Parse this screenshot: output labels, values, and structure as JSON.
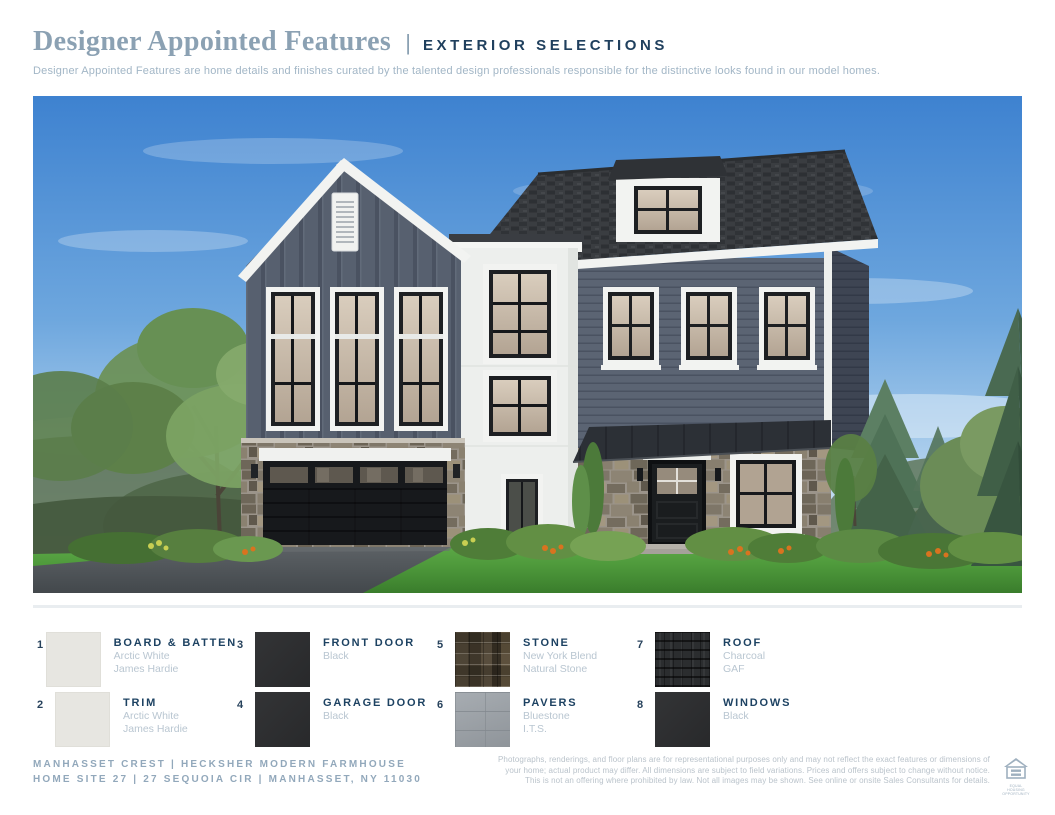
{
  "header": {
    "title": "Designer Appointed Features",
    "divider": "|",
    "subtitle_tag": "EXTERIOR SELECTIONS",
    "description": "Designer Appointed Features are home details and finishes curated by the talented design professionals responsible for the distinctive looks found in our model homes.",
    "title_color": "#8ba1b3",
    "tag_color": "#20405e"
  },
  "legend": {
    "items": [
      {
        "num": "1",
        "name": "BOARD & BATTEN",
        "line1": "Arctic White",
        "line2": "James Hardie",
        "swatch": "arctic-white",
        "swatch_color": "#e7e6e1"
      },
      {
        "num": "2",
        "name": "TRIM",
        "line1": "Arctic White",
        "line2": "James Hardie",
        "swatch": "arctic-white",
        "swatch_color": "#e7e6e1"
      },
      {
        "num": "3",
        "name": "FRONT DOOR",
        "line1": "Black",
        "line2": "",
        "swatch": "black",
        "swatch_color": "#2d2e30"
      },
      {
        "num": "4",
        "name": "GARAGE DOOR",
        "line1": "Black",
        "line2": "",
        "swatch": "black",
        "swatch_color": "#2d2e30"
      },
      {
        "num": "5",
        "name": "STONE",
        "line1": "New York Blend",
        "line2": "Natural Stone",
        "swatch": "stone",
        "swatch_color": "#7e7668"
      },
      {
        "num": "6",
        "name": "PAVERS",
        "line1": "Bluestone",
        "line2": "I.T.S.",
        "swatch": "pavers",
        "swatch_color": "#9ba1a7"
      },
      {
        "num": "7",
        "name": "ROOF",
        "line1": "Charcoal",
        "line2": "GAF",
        "swatch": "roof",
        "swatch_color": "#2b2d2f"
      },
      {
        "num": "8",
        "name": "WINDOWS",
        "line1": "Black",
        "line2": "",
        "swatch": "black",
        "swatch_color": "#28292b"
      }
    ]
  },
  "footer": {
    "left_line1": "MANHASSET CREST  |  HECKSHER MODERN FARMHOUSE",
    "left_line2": "HOME SITE 27  |  27 SEQUOIA CIR  |  MANHASSET, NY 11030",
    "disclaimer": [
      "Photographs, renderings, and floor plans are for representational purposes only and may not reflect the exact features or dimensions of",
      "your home; actual product may differ. All dimensions are subject to field variations. Prices and offers subject to change without notice.",
      "This is not an offering where prohibited by law. Not all images may be shown. See online or onsite Sales Consultants for details."
    ],
    "eho_line1": "EQUAL HOUSING",
    "eho_line2": "OPPORTUNITY"
  }
}
